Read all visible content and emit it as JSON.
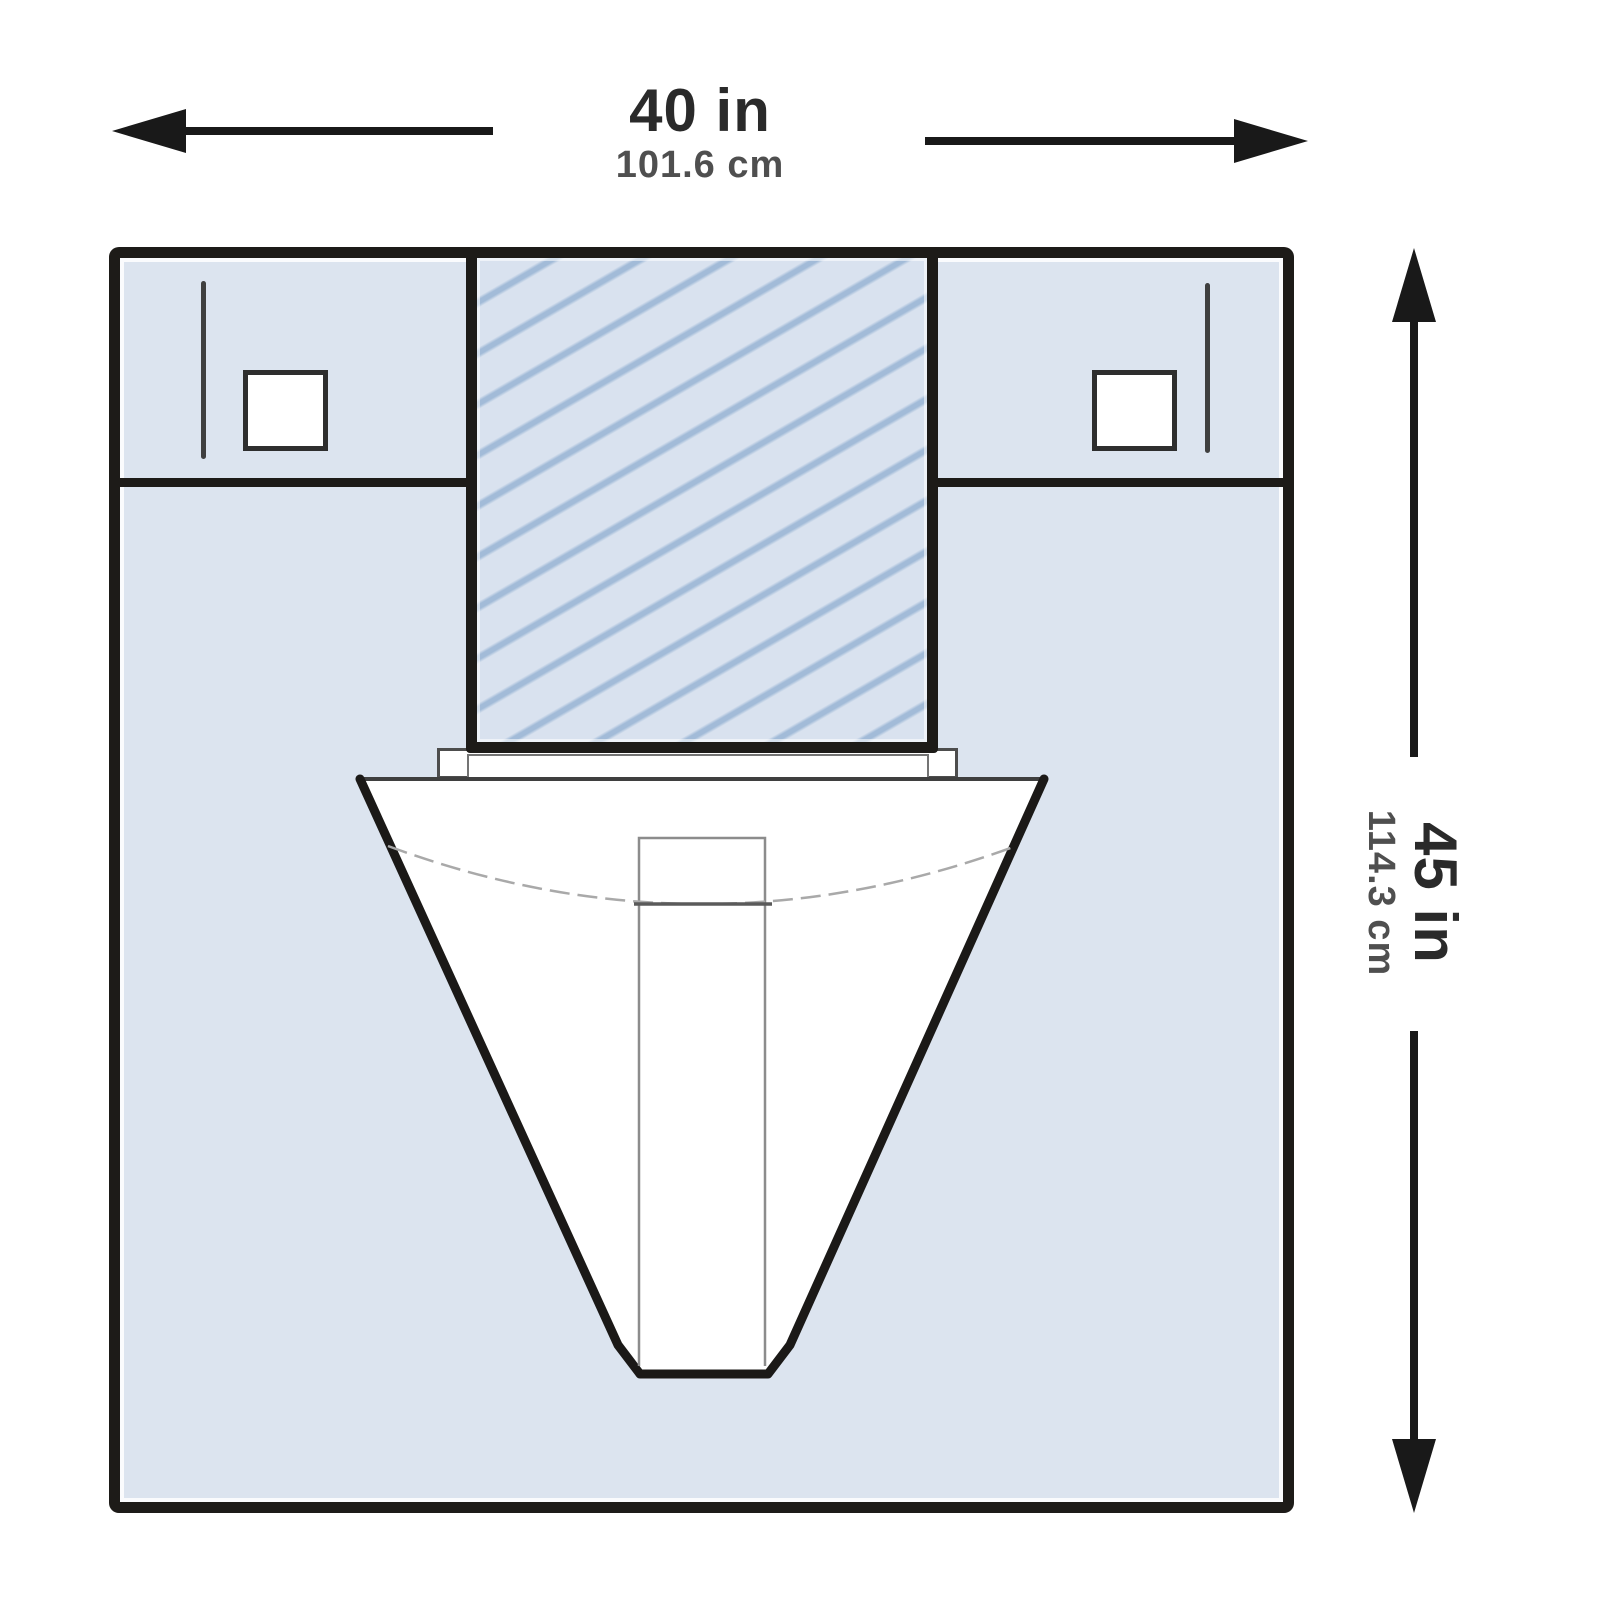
{
  "diagram": {
    "type": "product-dimension-diagram",
    "subject": "surgical drape with fenestration and fluid-collection pouch",
    "dimensions": {
      "width": {
        "in": "40 in",
        "cm": "101.6 cm"
      },
      "height": {
        "in": "45 in",
        "cm": "114.3 cm"
      }
    },
    "icons": {
      "width_arrow_left": "arrow-left",
      "width_arrow_right": "arrow-right",
      "height_arrow_up": "arrow-up",
      "height_arrow_down": "arrow-down"
    }
  },
  "colors": {
    "drape_fill": "#dce4ef",
    "hatch_fill": "#d9e2ef",
    "hatch_stripe": "#a2bbd8",
    "outline": "#1d1b18",
    "pouch_fill": "#ffffff",
    "pouch_line": "#1b1917",
    "dim_text_primary": "#2a2a2a",
    "dim_text_secondary": "#4f4f4f"
  }
}
